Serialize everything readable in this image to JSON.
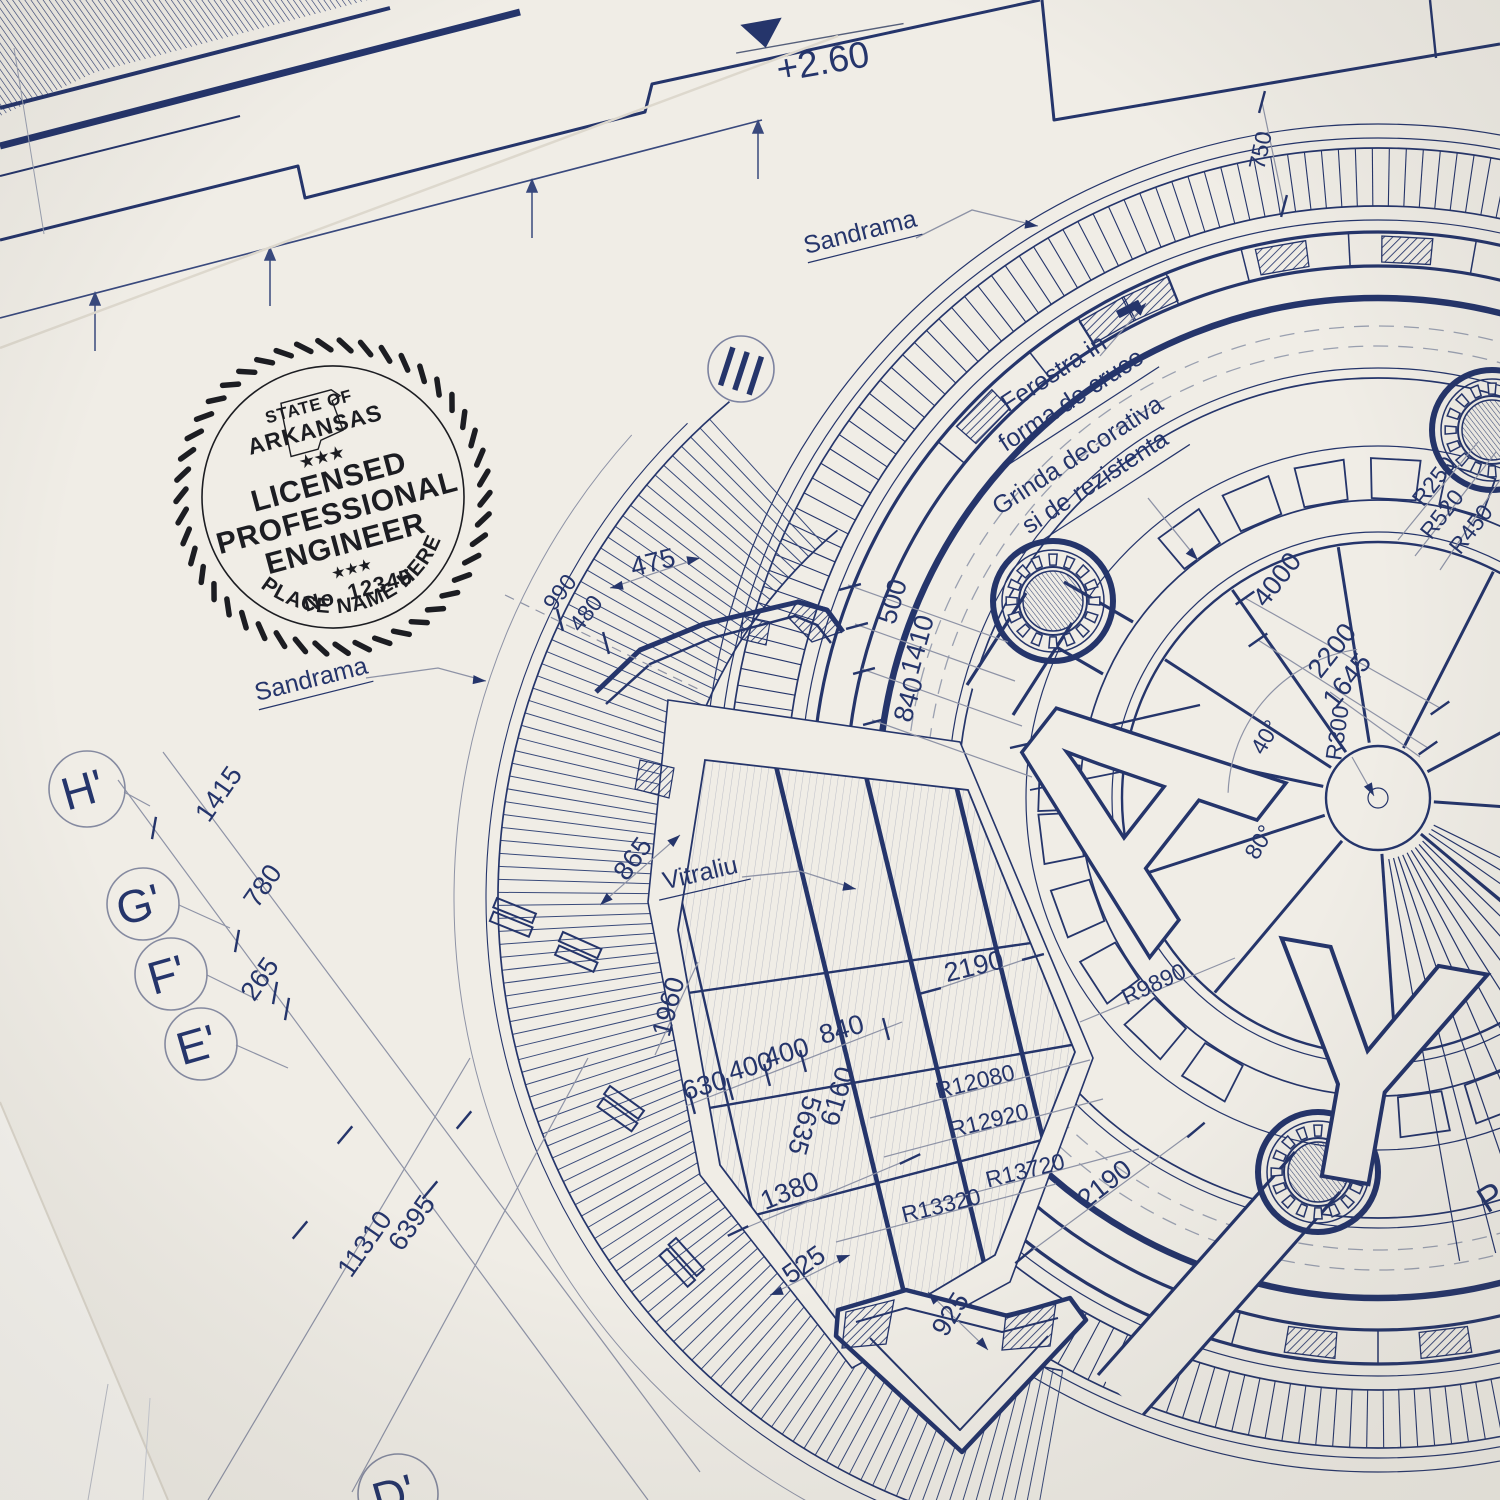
{
  "colors": {
    "ink": "#25356b",
    "paper": "#f0ede6",
    "paper_under": "#f7f5f0",
    "dim_line": "#8e93a6",
    "stamp_ink": "#1c1d22"
  },
  "stamp": {
    "state_of": "STATE OF",
    "state": "ARKANSAS",
    "stars_top": "★★★",
    "word1": "LICENSED",
    "word2": "PROFESSIONAL",
    "word3": "ENGINEER",
    "stars_bottom": "★★★",
    "license_no": "No. 12345",
    "name_placeholder": "PLACE NAME HERE"
  },
  "labels": {
    "level": "+2.60",
    "sandrama_top": "Sandrama",
    "sandrama_left": "Sandrama",
    "ferestra_line1": "Ferestra in",
    "ferestra_line2": "forma de cruce",
    "grinda_line1": "Grinda decorativa",
    "grinda_line2": "si de rezistenta",
    "vitraliu": "Vitraliu",
    "section": "III",
    "letter_a": "A",
    "letter_y": "Y",
    "edge_fragment": "P"
  },
  "grid_bubbles": {
    "h": "H'",
    "g": "G'",
    "f": "F'",
    "e": "E'",
    "d": "D'"
  },
  "dims": {
    "d475": "475",
    "d990": "990",
    "d480": "480",
    "d500": "500",
    "d1410": "1410",
    "d840_top": "840",
    "d865": "865",
    "d1960": "1960",
    "d630": "630",
    "d400_a": "400",
    "d400_b": "400",
    "d840_mid": "840",
    "d5635": "5635",
    "d6160": "6160",
    "d2190_top": "2190",
    "d2190_bot": "2190",
    "d1380": "1380",
    "d525": "525",
    "d925": "925",
    "d6395": "6395",
    "d11310": "11310",
    "d1415": "1415",
    "d780": "780",
    "d265": "265",
    "d750": "750",
    "d4000": "4000",
    "d2200": "2200",
    "d1645": "1645",
    "r300": "R300",
    "a40": "40°",
    "a80": "80°",
    "r250": "R250",
    "r520": "R520",
    "r450": "R450",
    "r9890": "R9890",
    "r12080": "R12080",
    "r12920": "R12920",
    "r13720": "R13720",
    "r13320": "R13320"
  }
}
